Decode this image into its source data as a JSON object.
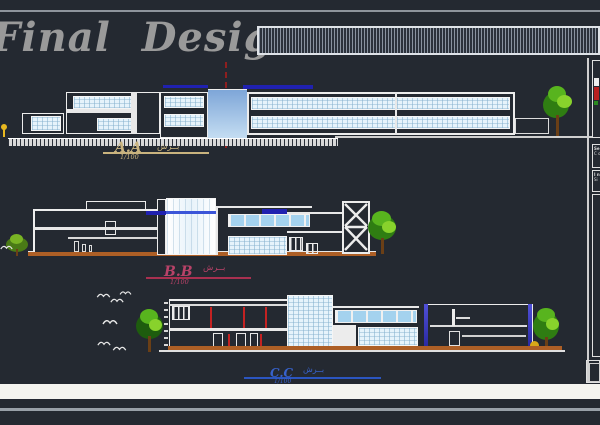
{
  "header": {
    "title": "Final Design"
  },
  "sections": {
    "a": {
      "name": "A.A",
      "scale": "1/100",
      "tag": "بــرش",
      "color": "#c9b37e"
    },
    "b": {
      "name": "B.B",
      "scale": "1/100",
      "tag": "بــرش",
      "color": "#b84268"
    },
    "c": {
      "name": "C.C",
      "scale": "1/100",
      "tag": "بــرش",
      "color": "#3762cc"
    }
  },
  "title_block": {
    "row1a": "Se",
    "row1b": "C o",
    "row2a": "I n",
    "row2b": "Si"
  },
  "colors": {
    "background": "#242931",
    "line_white": "#ececec",
    "roof_blue": "#2021b0",
    "tower_gradient_top": "#7ea6d8",
    "tower_gradient_bottom": "#c4ddf2",
    "ground_earth": "#ad5f26",
    "red_column": "#c42222",
    "red_centerline": "#8e1f1f",
    "tree_green": "#58b41e",
    "header_gray": "#9a9a9a"
  }
}
